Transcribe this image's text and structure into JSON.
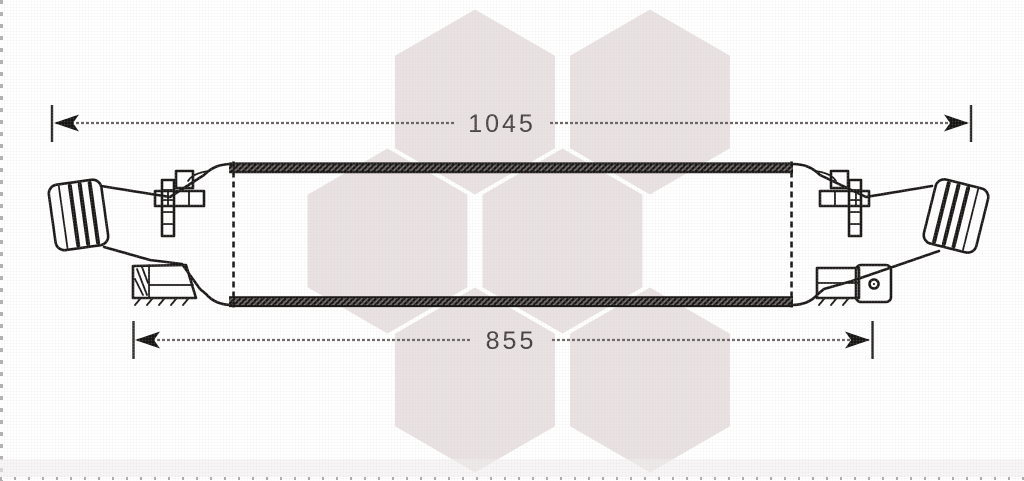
{
  "image": {
    "subject": "intercooler",
    "description": "Technical line drawing of an intercooler with overall and core width dimensions, hexagon honeycomb watermark"
  },
  "dimensions": {
    "overall_width": {
      "label": "1045"
    },
    "core_width": {
      "label": "855"
    }
  },
  "colors": {
    "background": "#ffffff",
    "line": "#1b1818",
    "dimension_line": "#6b6464",
    "dimension_text": "#474040",
    "watermark": "#e9e2e2",
    "edge_dash": "#9a9494"
  }
}
